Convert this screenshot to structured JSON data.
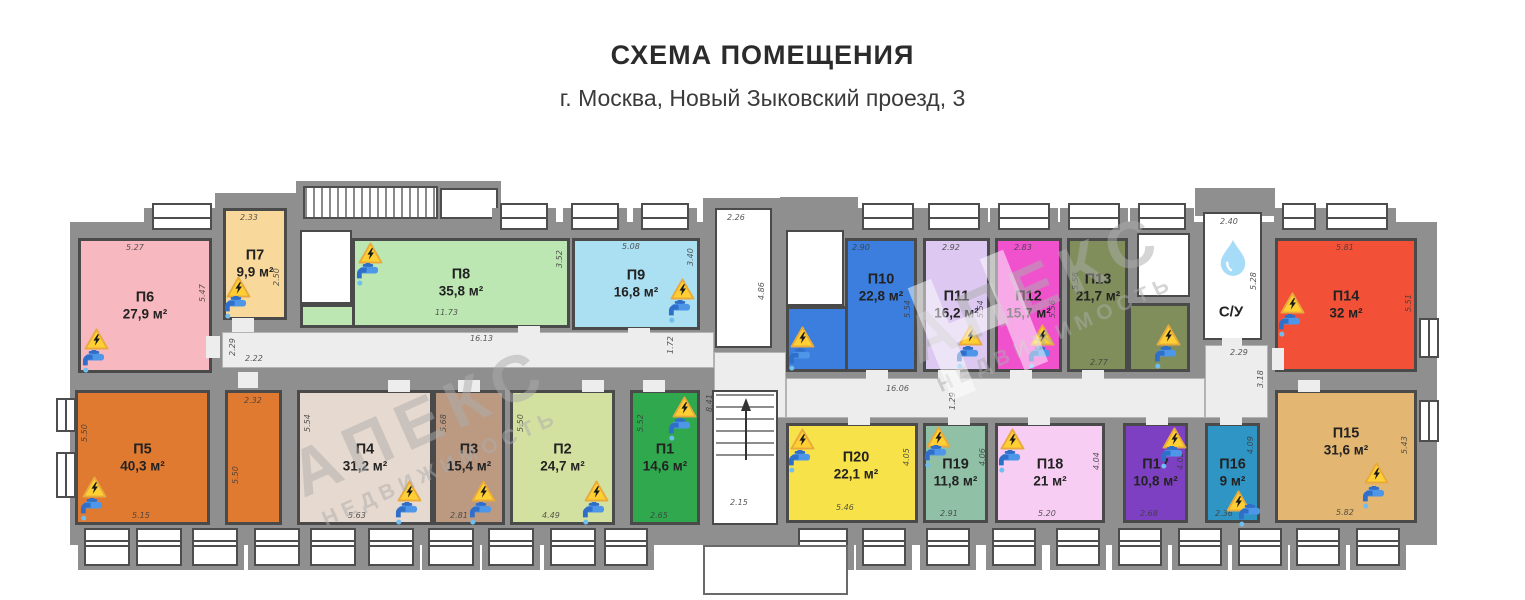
{
  "title": "СХЕМА ПОМЕЩЕНИЯ",
  "subtitle": "г. Москва, Новый Зыковский проезд, 3",
  "watermark": {
    "brand": "АПЕКС",
    "tagline": "НЕДВИЖИМОСТЬ",
    "monogram": "Н"
  },
  "plan": {
    "wall_color": "#8f8f8f",
    "walls": [
      [
        70,
        222,
        1367,
        323
      ],
      [
        215,
        193,
        85,
        32
      ],
      [
        296,
        181,
        205,
        44
      ],
      [
        703,
        198,
        82,
        27
      ],
      [
        780,
        197,
        78,
        28
      ],
      [
        1195,
        188,
        80,
        28
      ]
    ],
    "corridors": [
      [
        222,
        332,
        492,
        36
      ],
      [
        714,
        352,
        72,
        66
      ],
      [
        786,
        378,
        419,
        40
      ],
      [
        1205,
        345,
        63,
        73
      ]
    ],
    "stair_hatches": [
      {
        "rect": [
          303,
          186,
          135,
          33
        ],
        "hatched": true
      },
      {
        "rect": [
          440,
          188,
          58,
          31
        ],
        "hatched": false
      }
    ],
    "white_rooms": [
      {
        "name": "stair-upper",
        "rect": [
          715,
          208,
          57,
          140
        ],
        "dims": [
          {
            "t": "2.26",
            "x": 727,
            "y": 213,
            "r": 0
          },
          {
            "t": "4.86",
            "x": 757,
            "y": 300,
            "r": 1
          }
        ]
      },
      {
        "name": "stair-lower",
        "rect": [
          712,
          390,
          66,
          135
        ],
        "stairs": true,
        "dims": [
          {
            "t": "2.15",
            "x": 730,
            "y": 498,
            "r": 0
          },
          {
            "t": "8.41",
            "x": 705,
            "y": 412,
            "r": 1
          }
        ]
      },
      {
        "name": "utility-1",
        "rect": [
          300,
          230,
          52,
          74
        ],
        "dims": []
      },
      {
        "name": "utility-2",
        "rect": [
          786,
          230,
          58,
          76
        ],
        "dims": []
      },
      {
        "name": "utility-3",
        "rect": [
          1137,
          233,
          53,
          64
        ],
        "dims": []
      },
      {
        "name": "bathroom",
        "rect": [
          1203,
          212,
          59,
          128
        ],
        "label": "С/У",
        "drop": [
          1217,
          238
        ],
        "label_at": [
          1231,
          312
        ],
        "dims": [
          {
            "t": "2.40",
            "x": 1220,
            "y": 217,
            "r": 0
          },
          {
            "t": "5.28",
            "x": 1249,
            "y": 290,
            "r": 1
          }
        ]
      }
    ],
    "corridor_dims": [
      {
        "t": "2.29",
        "x": 228,
        "y": 356,
        "r": 1
      },
      {
        "t": "2.22",
        "x": 245,
        "y": 354,
        "r": 0
      },
      {
        "t": "16.13",
        "x": 470,
        "y": 334,
        "r": 0
      },
      {
        "t": "1.72",
        "x": 666,
        "y": 354,
        "r": 1
      },
      {
        "t": "16.06",
        "x": 886,
        "y": 384,
        "r": 0
      },
      {
        "t": "1.29",
        "x": 948,
        "y": 410,
        "r": 1
      },
      {
        "t": "2.29",
        "x": 1230,
        "y": 348,
        "r": 0
      },
      {
        "t": "3.18",
        "x": 1256,
        "y": 388,
        "r": 1
      }
    ],
    "rooms": [
      {
        "id": "П1",
        "area": "14,6 м²",
        "color": "#2fa84e",
        "rect": [
          630,
          390,
          70,
          135
        ],
        "dims": [
          {
            "t": "5.52",
            "x": 636,
            "y": 432,
            "r": 1
          },
          {
            "t": "2.65",
            "x": 650,
            "y": 511,
            "r": 0
          }
        ],
        "warn": [
          672,
          396
        ],
        "tap": [
          666,
          418
        ]
      },
      {
        "id": "П2",
        "area": "24,7 м²",
        "color": "#d2e1a0",
        "rect": [
          510,
          390,
          105,
          135
        ],
        "dims": [
          {
            "t": "5.50",
            "x": 516,
            "y": 432,
            "r": 1
          },
          {
            "t": "4.49",
            "x": 542,
            "y": 511,
            "r": 0
          }
        ],
        "warn": [
          584,
          480
        ],
        "tap": [
          580,
          502
        ]
      },
      {
        "id": "П3",
        "area": "15,4 м²",
        "color": "#bc9a82",
        "rect": [
          433,
          390,
          72,
          135
        ],
        "dims": [
          {
            "t": "5.68",
            "x": 439,
            "y": 432,
            "r": 1
          },
          {
            "t": "2.81",
            "x": 450,
            "y": 511,
            "r": 0
          }
        ],
        "warn": [
          471,
          480
        ],
        "tap": [
          467,
          502
        ]
      },
      {
        "id": "П4",
        "area": "31,2 м²",
        "color": "#e6d9cf",
        "rect": [
          297,
          390,
          136,
          135
        ],
        "dims": [
          {
            "t": "5.54",
            "x": 303,
            "y": 432,
            "r": 1
          },
          {
            "t": "5.63",
            "x": 348,
            "y": 511,
            "r": 0
          }
        ],
        "warn": [
          397,
          480
        ],
        "tap": [
          393,
          502
        ]
      },
      {
        "id": "П5",
        "area": "40,3 м²",
        "color": "#e07a30",
        "rect": [
          75,
          390,
          135,
          135
        ],
        "ext": [
          225,
          390,
          57,
          135
        ],
        "dims": [
          {
            "t": "5.50",
            "x": 80,
            "y": 442,
            "r": 1
          },
          {
            "t": "5.15",
            "x": 132,
            "y": 511,
            "r": 0
          },
          {
            "t": "2.32",
            "x": 244,
            "y": 396,
            "r": 0
          },
          {
            "t": "5.50",
            "x": 231,
            "y": 484,
            "r": 1
          }
        ],
        "warn": [
          82,
          476
        ],
        "tap": [
          78,
          498
        ]
      },
      {
        "id": "П6",
        "area": "27,9 м²",
        "color": "#f7b8bf",
        "rect": [
          78,
          238,
          134,
          135
        ],
        "dims": [
          {
            "t": "5.27",
            "x": 126,
            "y": 243,
            "r": 0
          },
          {
            "t": "5.47",
            "x": 198,
            "y": 302,
            "r": 1
          }
        ],
        "warn": [
          84,
          328
        ],
        "tap": [
          80,
          350
        ]
      },
      {
        "id": "П7",
        "area": "9,9 м²",
        "color": "#f9d99b",
        "rect": [
          223,
          208,
          64,
          112
        ],
        "dims": [
          {
            "t": "2.33",
            "x": 240,
            "y": 213,
            "r": 0
          },
          {
            "t": "2.50",
            "x": 272,
            "y": 286,
            "r": 1
          }
        ],
        "warn": [
          226,
          276
        ],
        "tap": [
          222,
          296
        ]
      },
      {
        "id": "П8",
        "area": "35,8 м²",
        "color": "#bce7b2",
        "rect": [
          352,
          238,
          218,
          90
        ],
        "ext": [
          300,
          304,
          55,
          24
        ],
        "dims": [
          {
            "t": "11.73",
            "x": 435,
            "y": 308,
            "r": 0
          },
          {
            "t": "3.52",
            "x": 555,
            "y": 268,
            "r": 1
          }
        ],
        "warn": [
          358,
          242
        ],
        "tap": [
          354,
          263
        ]
      },
      {
        "id": "П9",
        "area": "16,8 м²",
        "color": "#abdff2",
        "rect": [
          572,
          238,
          128,
          92
        ],
        "dims": [
          {
            "t": "5.08",
            "x": 622,
            "y": 242,
            "r": 0
          },
          {
            "t": "3.40",
            "x": 686,
            "y": 266,
            "r": 1
          }
        ],
        "warn": [
          670,
          278
        ],
        "tap": [
          666,
          300
        ]
      },
      {
        "id": "П10",
        "area": "22,8 м²",
        "color": "#3b7edd",
        "rect": [
          845,
          238,
          72,
          134
        ],
        "ext": [
          786,
          306,
          62,
          66
        ],
        "label_at": [
          881,
          288
        ],
        "dims": [
          {
            "t": "2.90",
            "x": 852,
            "y": 243,
            "r": 0
          },
          {
            "t": "5.54",
            "x": 903,
            "y": 318,
            "r": 1
          }
        ],
        "warn": [
          790,
          326
        ],
        "tap": [
          786,
          348
        ]
      },
      {
        "id": "П11",
        "area": "16,2 м²",
        "color": "#dcc8f0",
        "rect": [
          923,
          238,
          67,
          134
        ],
        "dims": [
          {
            "t": "2.92",
            "x": 942,
            "y": 243,
            "r": 0
          },
          {
            "t": "5.54",
            "x": 976,
            "y": 318,
            "r": 1
          }
        ],
        "warn": [
          958,
          324
        ],
        "tap": [
          954,
          346
        ]
      },
      {
        "id": "П12",
        "area": "15,7 м²",
        "color": "#f052ce",
        "rect": [
          995,
          238,
          67,
          134
        ],
        "dims": [
          {
            "t": "2.83",
            "x": 1014,
            "y": 243,
            "r": 0
          },
          {
            "t": "5.56",
            "x": 1048,
            "y": 318,
            "r": 1
          }
        ],
        "warn": [
          1030,
          324
        ],
        "tap": [
          1026,
          346
        ]
      },
      {
        "id": "П13",
        "area": "21,7 м²",
        "color": "#7f8e5a",
        "rect": [
          1067,
          238,
          61,
          134
        ],
        "ext": [
          1128,
          303,
          62,
          69
        ],
        "label_at": [
          1098,
          288
        ],
        "dims": [
          {
            "t": "5.58",
            "x": 1071,
            "y": 290,
            "r": 1
          },
          {
            "t": "2.77",
            "x": 1090,
            "y": 358,
            "r": 0
          }
        ],
        "warn": [
          1156,
          324
        ],
        "tap": [
          1152,
          346
        ]
      },
      {
        "id": "П14",
        "area": "32 м²",
        "color": "#f25138",
        "rect": [
          1275,
          238,
          142,
          134
        ],
        "dims": [
          {
            "t": "5.81",
            "x": 1336,
            "y": 243,
            "r": 0
          },
          {
            "t": "5.51",
            "x": 1404,
            "y": 312,
            "r": 1
          }
        ],
        "warn": [
          1280,
          292
        ],
        "tap": [
          1276,
          314
        ]
      },
      {
        "id": "П15",
        "area": "31,6 м²",
        "color": "#e3b671",
        "rect": [
          1275,
          390,
          142,
          133
        ],
        "label_at": [
          1346,
          442
        ],
        "dims": [
          {
            "t": "5.43",
            "x": 1400,
            "y": 454,
            "r": 1
          },
          {
            "t": "5.82",
            "x": 1336,
            "y": 508,
            "r": 0
          }
        ],
        "warn": [
          1364,
          462
        ],
        "tap": [
          1360,
          486
        ]
      },
      {
        "id": "П16",
        "area": "9 м²",
        "color": "#2f95c5",
        "rect": [
          1205,
          423,
          55,
          100
        ],
        "dims": [
          {
            "t": "4.09",
            "x": 1246,
            "y": 454,
            "r": 1
          },
          {
            "t": "2.36",
            "x": 1215,
            "y": 509,
            "r": 0
          }
        ],
        "warn": [
          1226,
          490
        ],
        "tap": [
          1236,
          504
        ]
      },
      {
        "id": "П17",
        "area": "10,8 м²",
        "color": "#7d40c2",
        "rect": [
          1123,
          423,
          65,
          100
        ],
        "dims": [
          {
            "t": "4.02",
            "x": 1176,
            "y": 470,
            "r": 1
          },
          {
            "t": "2.68",
            "x": 1140,
            "y": 509,
            "r": 0
          }
        ],
        "warn": [
          1162,
          427
        ],
        "tap": [
          1158,
          446
        ]
      },
      {
        "id": "П18",
        "area": "21 м²",
        "color": "#f7cdf3",
        "rect": [
          995,
          423,
          110,
          100
        ],
        "dims": [
          {
            "t": "4.04",
            "x": 1092,
            "y": 470,
            "r": 1
          },
          {
            "t": "5.20",
            "x": 1038,
            "y": 509,
            "r": 0
          }
        ],
        "warn": [
          1000,
          428
        ],
        "tap": [
          996,
          450
        ]
      },
      {
        "id": "П19",
        "area": "11,8 м²",
        "color": "#90c0a6",
        "rect": [
          923,
          423,
          65,
          100
        ],
        "dims": [
          {
            "t": "4.06",
            "x": 978,
            "y": 466,
            "r": 1
          },
          {
            "t": "2.91",
            "x": 940,
            "y": 509,
            "r": 0
          }
        ],
        "warn": [
          926,
          426
        ],
        "tap": [
          922,
          445
        ]
      },
      {
        "id": "П20",
        "area": "22,1 м²",
        "color": "#f8e24a",
        "rect": [
          786,
          423,
          132,
          100
        ],
        "label_at": [
          856,
          466
        ],
        "dims": [
          {
            "t": "4.05",
            "x": 902,
            "y": 466,
            "r": 1
          },
          {
            "t": "5.46",
            "x": 836,
            "y": 503,
            "r": 0
          }
        ],
        "warn": [
          790,
          428
        ],
        "tap": [
          786,
          450
        ]
      }
    ],
    "windows": {
      "top": [
        [
          152,
          60
        ],
        [
          500,
          48
        ],
        [
          571,
          48
        ],
        [
          641,
          48
        ],
        [
          862,
          52
        ],
        [
          928,
          52
        ],
        [
          998,
          52
        ],
        [
          1068,
          52
        ],
        [
          1138,
          48
        ],
        [
          1282,
          34
        ],
        [
          1326,
          62
        ]
      ],
      "bottom": [
        [
          84,
          46
        ],
        [
          136,
          46
        ],
        [
          192,
          46
        ],
        [
          254,
          46
        ],
        [
          310,
          46
        ],
        [
          368,
          46
        ],
        [
          428,
          46
        ],
        [
          488,
          46
        ],
        [
          550,
          46
        ],
        [
          604,
          44
        ],
        [
          798,
          50
        ],
        [
          862,
          44
        ],
        [
          926,
          44
        ],
        [
          992,
          44
        ],
        [
          1056,
          44
        ],
        [
          1118,
          44
        ],
        [
          1178,
          44
        ],
        [
          1238,
          44
        ],
        [
          1296,
          44
        ],
        [
          1356,
          44
        ]
      ],
      "right": [
        [
          318,
          40
        ],
        [
          400,
          42
        ]
      ],
      "left": [
        [
          398,
          34
        ],
        [
          452,
          46
        ]
      ]
    },
    "doors": [
      [
        206,
        336,
        14,
        22
      ],
      [
        232,
        318,
        22,
        14
      ],
      [
        518,
        326,
        22,
        12
      ],
      [
        628,
        328,
        22,
        12
      ],
      [
        866,
        370,
        22,
        12
      ],
      [
        938,
        370,
        22,
        12
      ],
      [
        1010,
        370,
        22,
        12
      ],
      [
        1082,
        370,
        22,
        12
      ],
      [
        1272,
        348,
        12,
        22
      ],
      [
        1222,
        338,
        20,
        12
      ],
      [
        238,
        372,
        20,
        16
      ],
      [
        388,
        380,
        22,
        12
      ],
      [
        458,
        380,
        22,
        12
      ],
      [
        582,
        380,
        22,
        12
      ],
      [
        643,
        380,
        22,
        12
      ],
      [
        848,
        413,
        22,
        12
      ],
      [
        948,
        413,
        22,
        12
      ],
      [
        1028,
        413,
        22,
        12
      ],
      [
        1146,
        413,
        22,
        12
      ],
      [
        1220,
        413,
        22,
        12
      ],
      [
        1298,
        380,
        22,
        12
      ]
    ],
    "porch": [
      703,
      545,
      145,
      50
    ]
  }
}
